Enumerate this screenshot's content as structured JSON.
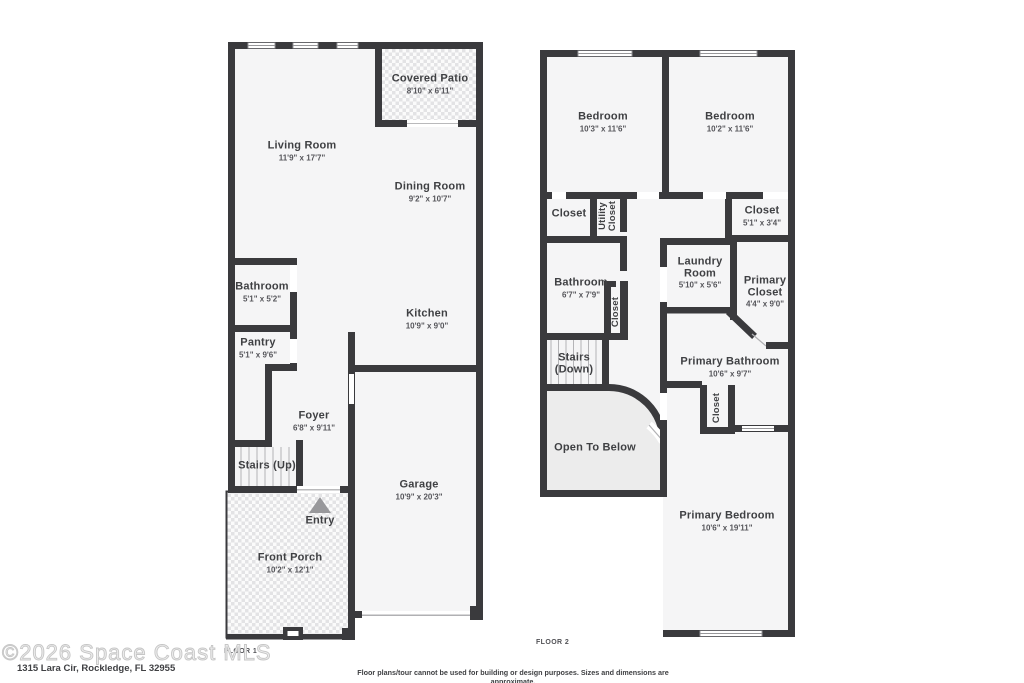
{
  "colors": {
    "wall": "#3a3a3d",
    "floor": "#f5f5f6",
    "open_to_below_fill": "#ececec",
    "hatch_square": "#e3e3e5",
    "label_text": "#3f4043"
  },
  "floor1": {
    "label": "FLOOR 1",
    "rooms": {
      "covered_patio": {
        "name": "Covered Patio",
        "dims": "8'10\" x 6'11\""
      },
      "living_room": {
        "name": "Living Room",
        "dims": "11'9\" x 17'7\""
      },
      "dining_room": {
        "name": "Dining Room",
        "dims": "9'2\" x 10'7\""
      },
      "bathroom": {
        "name": "Bathroom",
        "dims": "5'1\" x 5'2\""
      },
      "kitchen": {
        "name": "Kitchen",
        "dims": "10'9\" x 9'0\""
      },
      "pantry": {
        "name": "Pantry",
        "dims": "5'1\" x 9'6\""
      },
      "foyer": {
        "name": "Foyer",
        "dims": "6'8\" x 9'11\""
      },
      "stairs_up": {
        "name": "Stairs (Up)"
      },
      "garage": {
        "name": "Garage",
        "dims": "10'9\" x 20'3\""
      },
      "entry": {
        "name": "Entry"
      },
      "front_porch": {
        "name": "Front Porch",
        "dims": "10'2\" x 12'1\""
      }
    }
  },
  "floor2": {
    "label": "FLOOR 2",
    "rooms": {
      "bedroom_left": {
        "name": "Bedroom",
        "dims": "10'3\" x 11'6\""
      },
      "bedroom_right": {
        "name": "Bedroom",
        "dims": "10'2\" x 11'6\""
      },
      "closet_left": {
        "name": "Closet"
      },
      "utility_closet": {
        "name": "Utility Closet"
      },
      "closet_right": {
        "name": "Closet",
        "dims": "5'1\" x 3'4\""
      },
      "bathroom": {
        "name": "Bathroom",
        "dims": "6'7\" x 7'9\""
      },
      "bath_closet": {
        "name": "Closet"
      },
      "laundry_room": {
        "name": "Laundry Room",
        "dims": "5'10\" x 5'6\""
      },
      "primary_closet": {
        "name": "Primary Closet",
        "dims": "4'4\" x 9'0\""
      },
      "stairs_down": {
        "name": "Stairs (Down)"
      },
      "primary_bathroom": {
        "name": "Primary Bathroom",
        "dims": "10'6\" x 9'7\""
      },
      "bedroom_closet": {
        "name": "Closet"
      },
      "open_to_below": {
        "name": "Open To Below"
      },
      "primary_bedroom": {
        "name": "Primary Bedroom",
        "dims": "10'6\" x 19'11\""
      }
    }
  },
  "footer": {
    "watermark": "©2026 Space Coast MLS",
    "address": "1315 Lara Cir, Rockledge, FL 32955",
    "disclaimer": "Floor plans/tour cannot be used for building or design purposes. Sizes and dimensions are approximate."
  }
}
